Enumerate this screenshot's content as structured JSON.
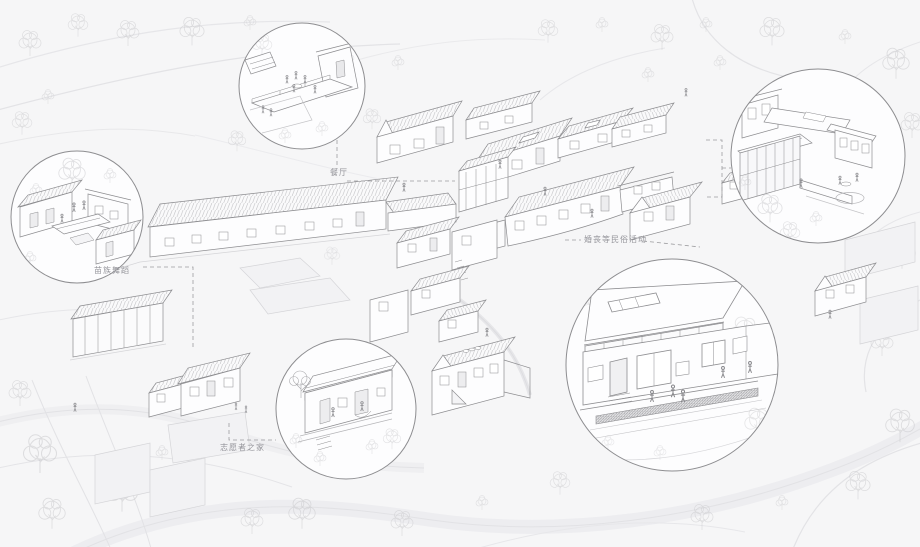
{
  "drawing": {
    "type": "axonometric-village-masterplan",
    "palette": {
      "background": "#f6f6f7",
      "building_line": "#8d8d90",
      "faint_line": "#d5d5d8",
      "roof_hatch": "#bfbfc2",
      "dashed_connector": "#9b9b9e",
      "label_text": "#94949a",
      "callout_fill": "#fdfdfe",
      "vegetation": "#c9c9cc"
    }
  },
  "labels": {
    "dining": "餐厅",
    "dance": "苗族舞蹈",
    "volunteer": "志愿者之家",
    "folk": "婚丧等民俗活动"
  }
}
